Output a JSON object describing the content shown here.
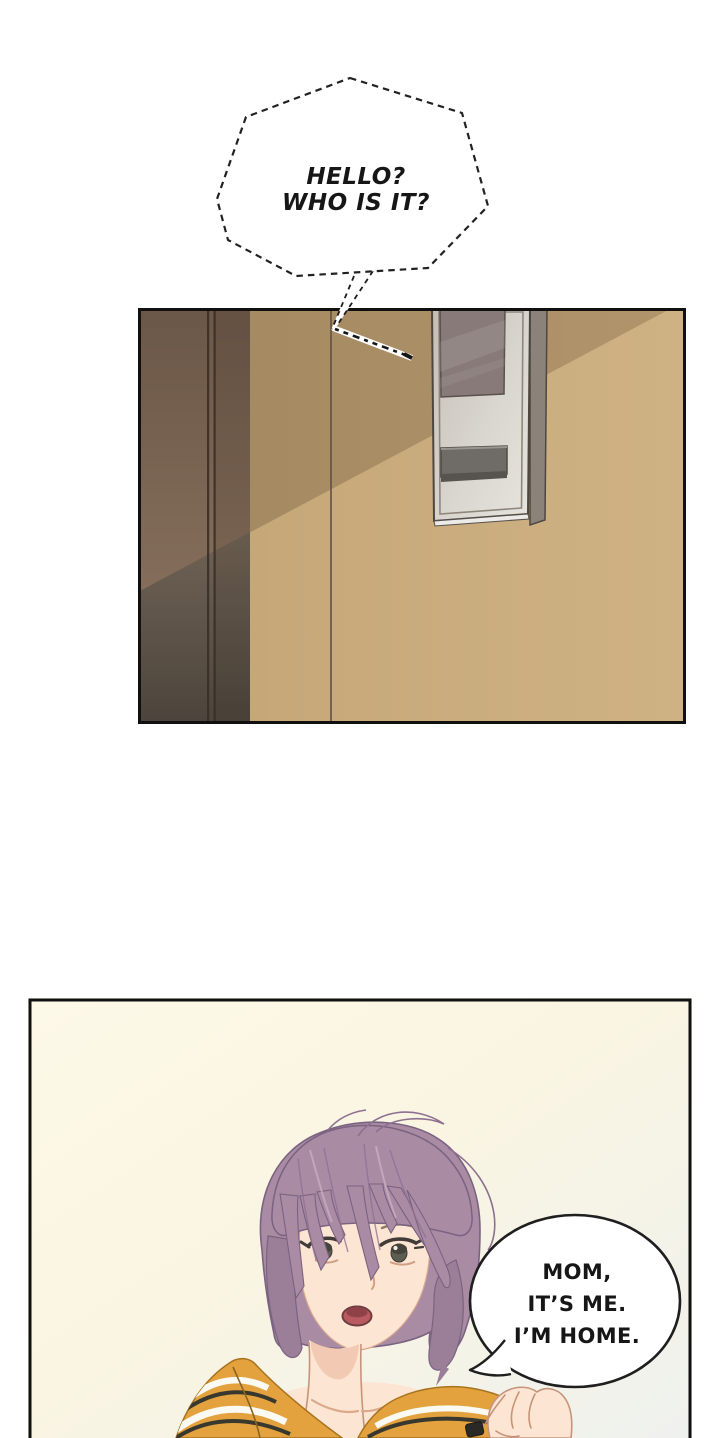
{
  "page": {
    "title": "webtoon comic page",
    "background_color": "#ffffff"
  },
  "panels": {
    "intercom_panel": {
      "label": "hallway wall with door frame and wall-mounted intercom"
    },
    "reply_panel": {
      "label": "short-haired person in striped mustard top answering"
    }
  },
  "speech": {
    "doorbell_bubble": {
      "style": "dashed-outline",
      "lines": [
        "HELLO?",
        "WHO IS IT?"
      ]
    },
    "reply_bubble": {
      "style": "solid-outline",
      "lines": [
        "MOM,",
        "IT’S ME.",
        "I’M HOME."
      ]
    }
  },
  "colors": {
    "wall_light": "#cdb081",
    "wall_shadow": "#a98d67",
    "door_frame_upper": "#8a7260",
    "door_frame_lower": "#52493f",
    "intercom_body": "#dfddd7",
    "intercom_screen": "#877a76",
    "intercom_button": "#6f6b66",
    "intercom_side": "#8b8379",
    "panel2_background": "#fbf7e5",
    "hair": "#a98ba4",
    "hair_shadow": "#8d7090",
    "skin": "#fce5d2",
    "shirt": "#e3a23e",
    "shirt_stripe_dark": "#39382f",
    "shirt_stripe_light": "#fbfaf2",
    "mouth": "#b85a60",
    "line_art": "#1f1f1f"
  }
}
